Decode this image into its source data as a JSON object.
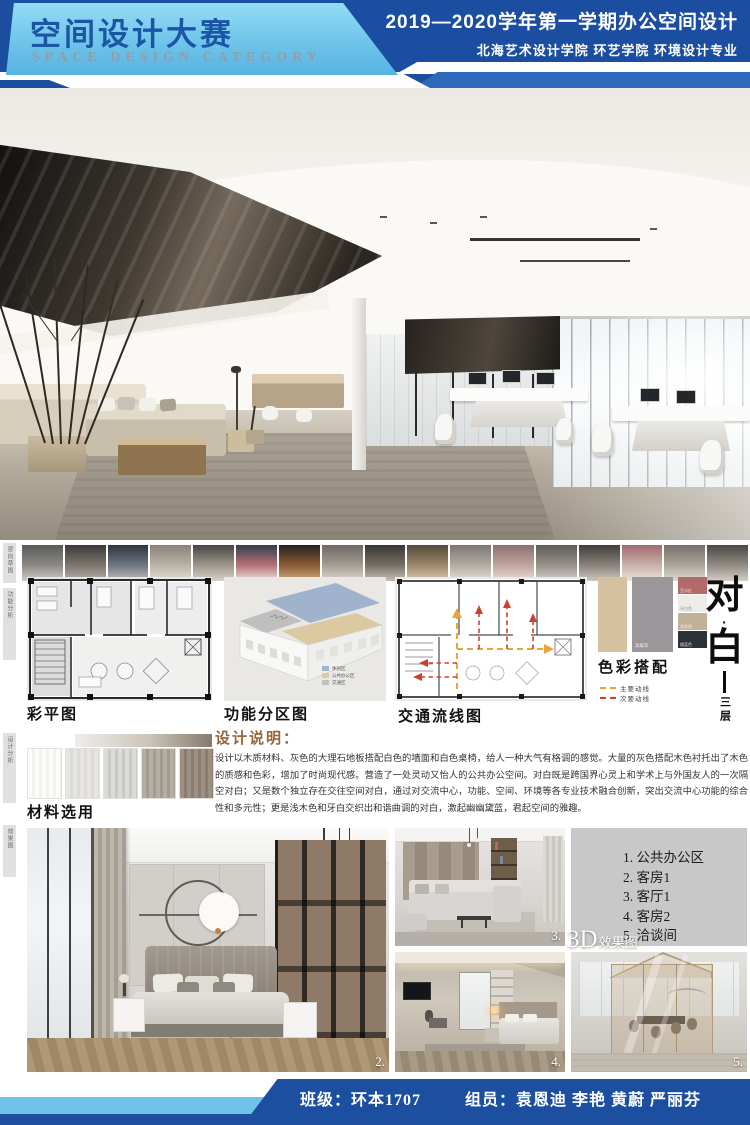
{
  "header": {
    "title_cn": "空间设计大赛",
    "title_en": "SPACE DESIGN CATEGORY",
    "course": "2019—2020学年第一学期办公空间设计",
    "school": "北海艺术设计学院 环艺学院 环境设计专业"
  },
  "side_labels": [
    "意向草图",
    "功能分析",
    "设计分析",
    "效果图"
  ],
  "thumbnails": [
    [
      "#5a5a58",
      "#8b8884",
      "#cfccc6"
    ],
    [
      "#3c3a38",
      "#7a746c",
      "#b9b2a8"
    ],
    [
      "#2e3640",
      "#6b7480",
      "#c2beb6"
    ],
    [
      "#8a837a",
      "#b8b1a6",
      "#e2ddd4"
    ],
    [
      "#474441",
      "#9c958c",
      "#d6d1c9"
    ],
    [
      "#30404e",
      "#b76f75",
      "#e8e2da"
    ],
    [
      "#24211e",
      "#8a5a34",
      "#caa97e"
    ],
    [
      "#6e6862",
      "#a39c93",
      "#dcd7cf"
    ],
    [
      "#3a3633",
      "#746d64",
      "#c4beb5"
    ],
    [
      "#55493c",
      "#9c8568",
      "#d9c9b2"
    ],
    [
      "#7d7770",
      "#b1aaa1",
      "#e4dfd8"
    ],
    [
      "#8d6f6e",
      "#c0a49f",
      "#e8ddd6"
    ],
    [
      "#5f5b55",
      "#96918a",
      "#d5d0c8"
    ],
    [
      "#413d3a",
      "#87817a",
      "#ccc7bf"
    ],
    [
      "#a06a6e",
      "#c9b0a8",
      "#ece4dc"
    ],
    [
      "#767069",
      "#aaa49b",
      "#dfdad2"
    ],
    [
      "#4c4845",
      "#908a82",
      "#d2cdc5"
    ]
  ],
  "plans": {
    "color_plan_label": "彩平图",
    "zoning_label": "功能分区图",
    "zoning_legend": [
      {
        "color": "#9fb4cc",
        "label": "休闲区"
      },
      {
        "color": "#dcc9a2",
        "label": "公共办公区"
      },
      {
        "color": "#bfbfbf",
        "label": "交通区"
      }
    ],
    "circulation_label": "交通流线图",
    "circulation_legend": [
      {
        "color": "#e8a53c",
        "label": "主要动线"
      },
      {
        "color": "#cd3f31",
        "label": "次要动线"
      }
    ]
  },
  "palette": {
    "title": "色彩搭配",
    "large": [
      {
        "color": "#d5c0a0",
        "label": ""
      },
      {
        "color": "#9a9699",
        "label": "高级灰"
      }
    ],
    "small": [
      {
        "color": "#b26a6b",
        "label": "豆沙红",
        "dark_text": false
      },
      {
        "color": "#edece8",
        "label": "牙白色",
        "dark_text": true
      },
      {
        "color": "#c2b199",
        "label": "浅木色",
        "dark_text": false
      },
      {
        "color": "#2c313a",
        "label": "黛蓝色",
        "dark_text": false
      }
    ]
  },
  "theme": {
    "char_top": "对",
    "dot": "·",
    "char_bottom": "白",
    "floor": "三层"
  },
  "materials": {
    "title": "材料选用",
    "swatches": [
      {
        "a": "#fcfcfa",
        "b": "#f2f2ee"
      },
      {
        "a": "#e6e5e1",
        "b": "#dcdbd6"
      },
      {
        "a": "#dbdbd9",
        "b": "#c8c8c6"
      },
      {
        "a": "#b5aea3",
        "b": "#a29b90"
      },
      {
        "a": "#9d8f82",
        "b": "#8a7c6f"
      }
    ]
  },
  "description": {
    "title": "设计说明：",
    "body": "设计以木质材料、灰色的大理石地板搭配白色的墙面和白色桌椅，给人一种大气有格调的感觉。大量的灰色搭配木色衬托出了木色的质感和色彩，增加了时尚现代感。营造了一处灵动又怡人的公共办公空间。对白既是跨国界心灵上和学术上与外国友人的一次隔空对白；又是数个独立存在交往空间对白，通过对交流中心，功能、空间、环境等各专业技术融合创新，突出交流中心功能的综合性和多元性；更是浅木色和牙白交织出和谐曲调的对白，激起幽幽黛蓝，君起空间的雅趣。"
  },
  "renders": {
    "label_3d_big": "3D",
    "label_3d_small": "效果图",
    "room_list": [
      "1. 公共办公区",
      "2. 客房1",
      "3. 客厅1",
      "4. 客房2",
      "5. 洽谈间"
    ],
    "numbers": [
      "2.",
      "3.",
      "4.",
      "5."
    ]
  },
  "footer": {
    "class_label": "班级：环本1707",
    "team_label": "组员：袁恩迪 李艳 黄蔚 严丽芬"
  },
  "colors": {
    "header_blue": "#1b4da0",
    "header_light_blue": "#7ccdee",
    "footer_blue": "#1c4fa0",
    "main_route": "#e8a53c",
    "secondary_route": "#cd3f31"
  }
}
